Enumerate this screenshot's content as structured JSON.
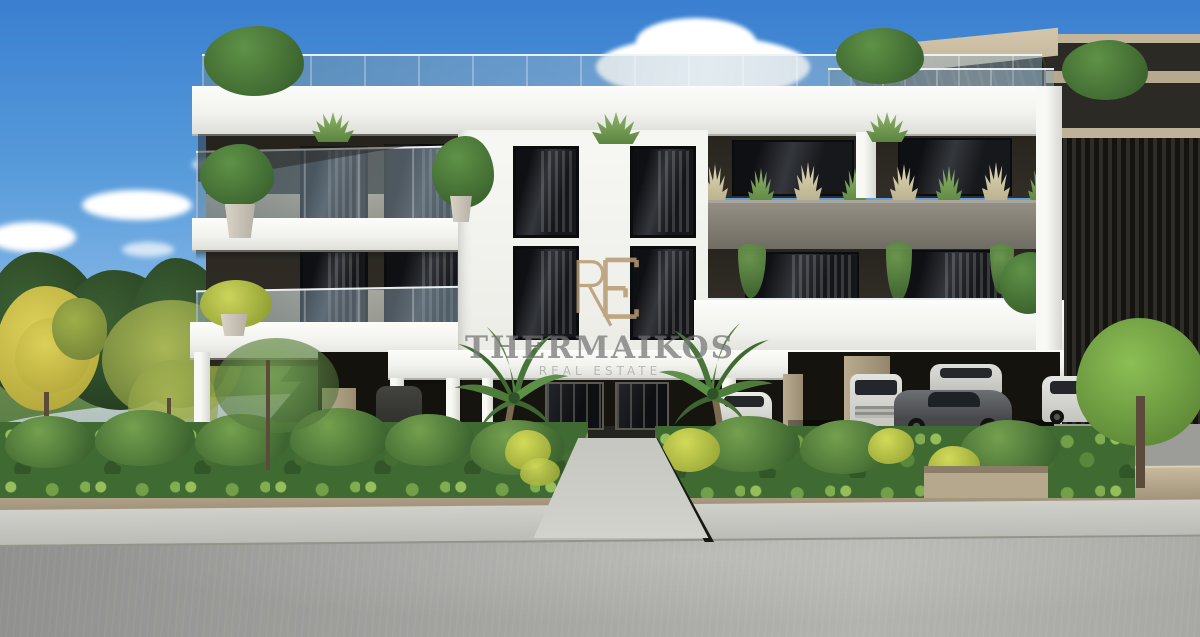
{
  "watermark": {
    "brand": "THERMAIKOS",
    "tagline": "REAL ESTATE",
    "monogram": "RE",
    "brand_color": "#5c5c5c",
    "tagline_color": "#969696",
    "monogram_color": "#b79a72"
  },
  "palette": {
    "sky_top": "#3a7fd0",
    "sky_horizon": "#e4eff8",
    "building_white": "#f6f6f3",
    "facade_dark": "#27241e",
    "accent_tan": "#c9bba1",
    "planter_gray": "#8b887e",
    "glass_blue": "#9db6c6",
    "lawn_green": "#5d8046",
    "foliage_green": "#4e7c3a",
    "foliage_yellow": "#c5cc4e",
    "road_gray": "#a5a5a2",
    "sidewalk_gray": "#c9c9c4",
    "curb_beige": "#b9ac92"
  },
  "scene": {
    "label": "3D architectural rendering of a modern three-storey apartment building with glass balconies, roof pergola, entrance canopy, palm trees, landscaped beds and covered parking with cars"
  }
}
